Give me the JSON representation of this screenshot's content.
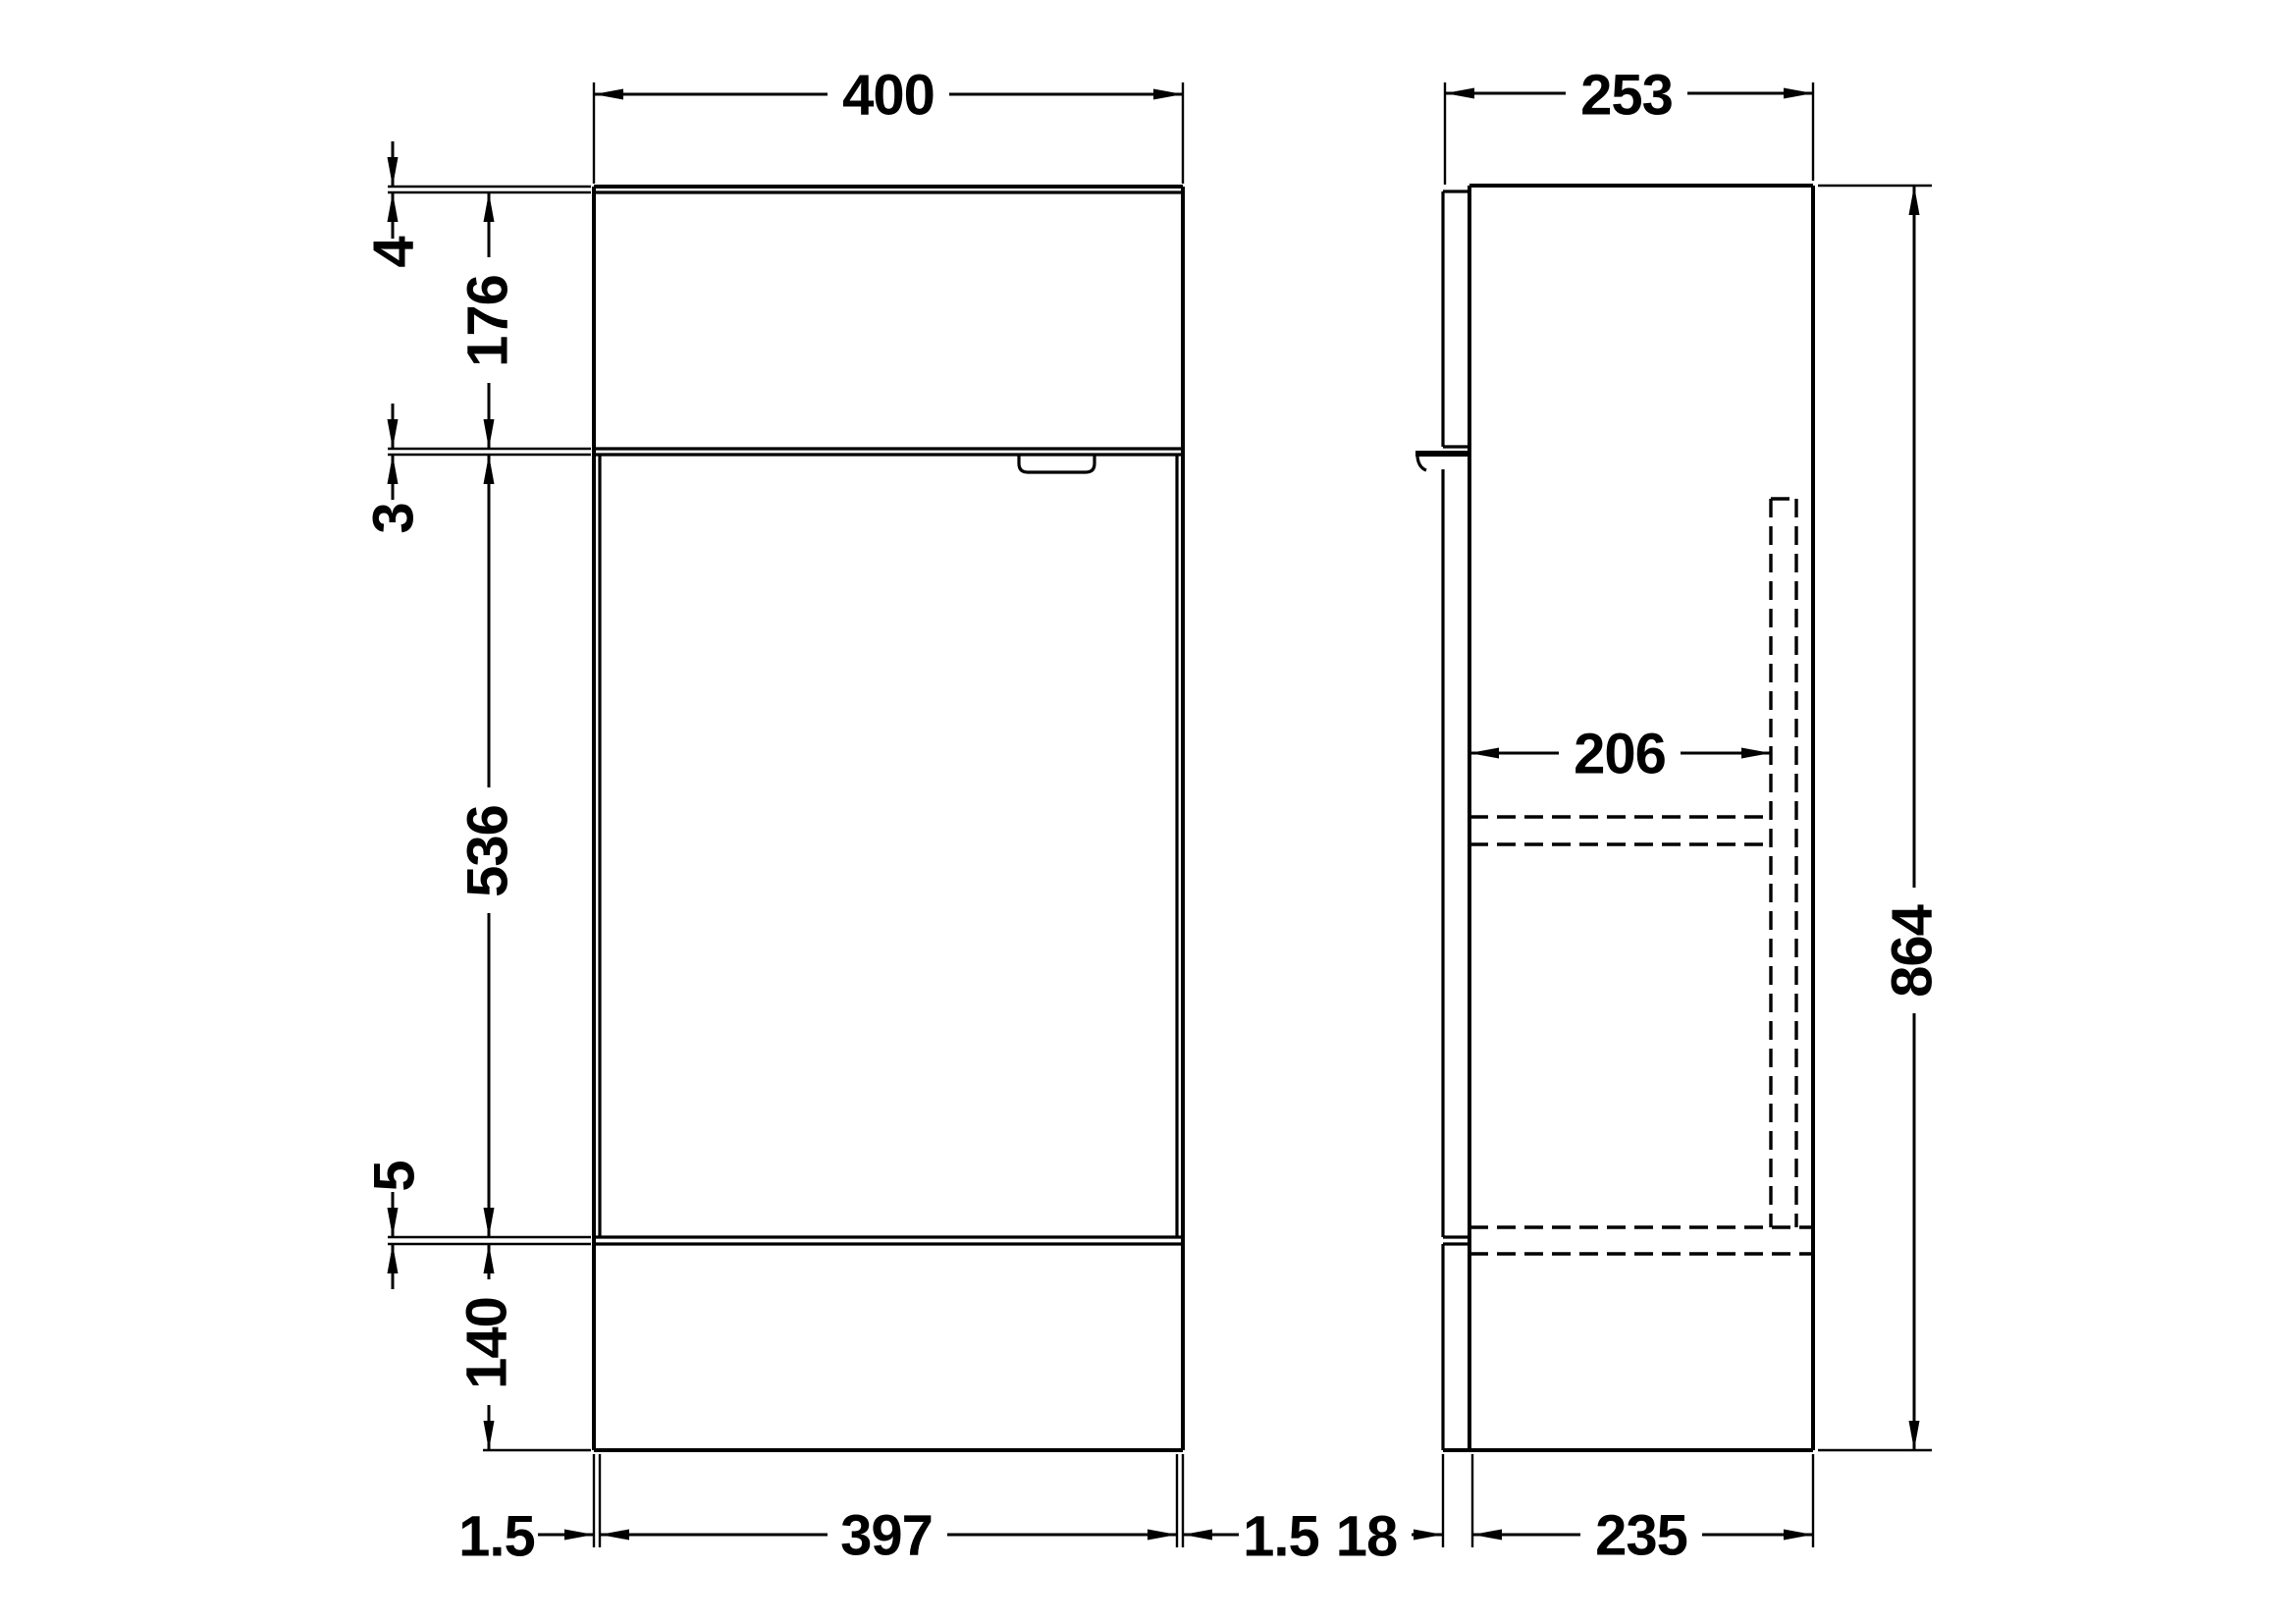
{
  "drawing": {
    "background_color": "#ffffff",
    "line_color": "#000000",
    "front_view": {
      "overall_width": "400",
      "worktop_thickness": "4",
      "upper_panel_height": "176",
      "upper_gap": "3",
      "door_height": "536",
      "lower_gap": "5",
      "plinth_height": "140",
      "left_gap": "1.5",
      "door_width": "397",
      "right_gap": "1.5"
    },
    "side_view": {
      "overall_depth": "253",
      "internal_depth": "206",
      "overall_height": "864",
      "front_panel_thickness": "18",
      "carcass_depth": "235"
    }
  }
}
